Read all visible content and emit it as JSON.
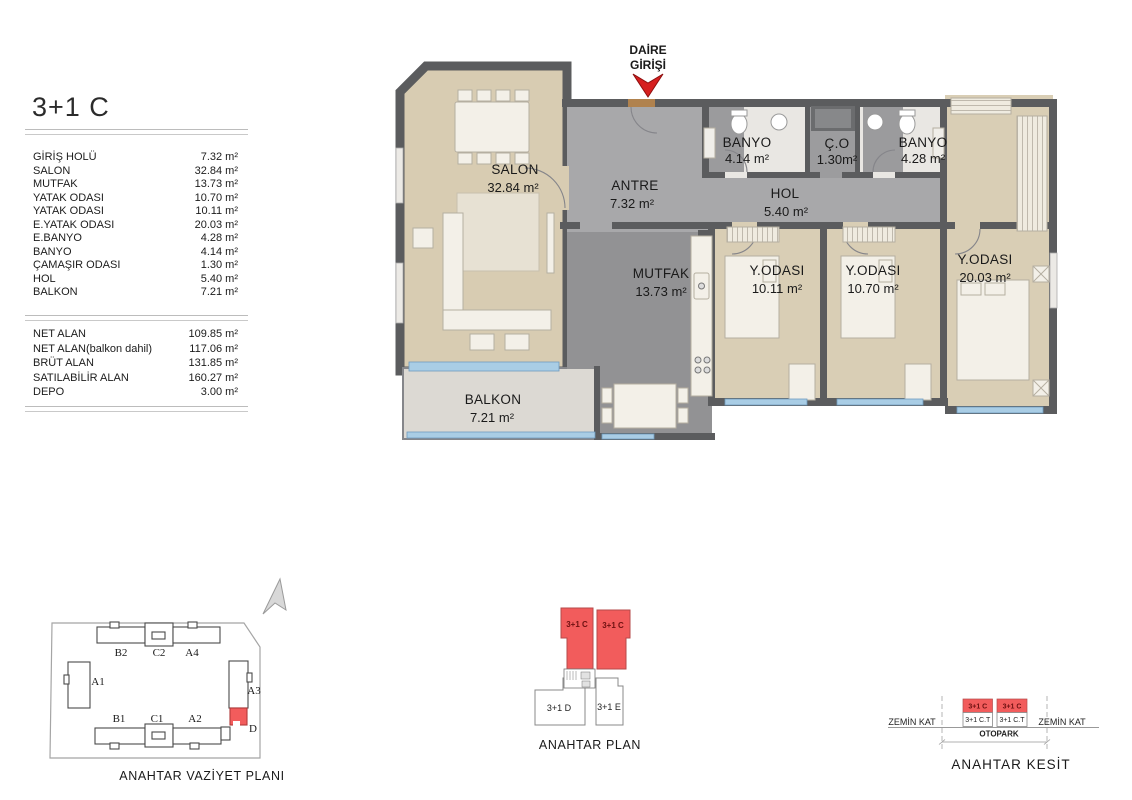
{
  "unit": {
    "title": "3+1 C"
  },
  "rooms_table": [
    {
      "label": "GİRİŞ HOLÜ",
      "value": "7.32 m²"
    },
    {
      "label": "SALON",
      "value": "32.84 m²"
    },
    {
      "label": "MUTFAK",
      "value": "13.73 m²"
    },
    {
      "label": "YATAK ODASI",
      "value": "10.70 m²"
    },
    {
      "label": "YATAK ODASI",
      "value": "10.11 m²"
    },
    {
      "label": "E.YATAK ODASI",
      "value": "20.03 m²"
    },
    {
      "label": "E.BANYO",
      "value": "4.28 m²"
    },
    {
      "label": "BANYO",
      "value": "4.14 m²"
    },
    {
      "label": "ÇAMAŞIR ODASI",
      "value": "1.30 m²"
    },
    {
      "label": "HOL",
      "value": "5.40 m²"
    },
    {
      "label": "BALKON",
      "value": "7.21 m²"
    }
  ],
  "summary_table": [
    {
      "label": "NET ALAN",
      "value": "109.85 m²"
    },
    {
      "label": "NET ALAN(balkon dahil)",
      "value": "117.06 m²"
    },
    {
      "label": "BRÜT ALAN",
      "value": "131.85 m²"
    },
    {
      "label": "SATILABİLİR ALAN",
      "value": "160.27 m²"
    },
    {
      "label": "DEPO",
      "value": "3.00 m²"
    }
  ],
  "plan": {
    "entrance": {
      "line1": "DAİRE",
      "line2": "GİRİŞİ"
    },
    "rooms": {
      "salon": {
        "name": "SALON",
        "area": "32.84 m²"
      },
      "antre": {
        "name": "ANTRE",
        "area": "7.32 m²"
      },
      "banyo1": {
        "name": "BANYO",
        "area": "4.14 m²"
      },
      "camasir": {
        "name": "Ç.O",
        "area": "1.30m²"
      },
      "banyo2": {
        "name": "BANYO",
        "area": "4.28 m²"
      },
      "hol": {
        "name": "HOL",
        "area": "5.40 m²"
      },
      "mutfak": {
        "name": "MUTFAK",
        "area": "13.73 m²"
      },
      "yatak1": {
        "name": "Y.ODASI",
        "area": "10.11 m²"
      },
      "yatak2": {
        "name": "Y.ODASI",
        "area": "10.70 m²"
      },
      "eyatak": {
        "name": "Y.ODASI",
        "area": "20.03 m²"
      },
      "balkon": {
        "name": "BALKON",
        "area": "7.21 m²"
      }
    }
  },
  "site_plan": {
    "title": "ANAHTAR VAZİYET PLANI",
    "blocks": {
      "b2": "B2",
      "c2": "C2",
      "a4": "A4",
      "a1": "A1",
      "a3": "A3",
      "b1": "B1",
      "c1": "C1",
      "a2": "A2",
      "d": "D"
    }
  },
  "key_plan": {
    "title": "ANAHTAR PLAN",
    "unit_left": "3+1 C",
    "unit_right": "3+1 C",
    "unit_d": "3+1 D",
    "unit_e": "3+1 E"
  },
  "key_section": {
    "title": "ANAHTAR KESİT",
    "zemin_left": "ZEMİN KAT",
    "zemin_right": "ZEMİN KAT",
    "top_left": "3+1 C",
    "top_right": "3+1 C",
    "bottom_left": "3+1 C.T",
    "bottom_right": "3+1 C.T",
    "otopark": "OTOPARK"
  },
  "colors": {
    "wall": "#5b5c5e",
    "wood_floor": "#d8ccb2",
    "tile_floor": "#a8a8aa",
    "kitchen_floor": "#929294",
    "window_blue": "#a9cde5",
    "unit_red": "#f25c5c",
    "arrow_red": "#d61f1f"
  }
}
